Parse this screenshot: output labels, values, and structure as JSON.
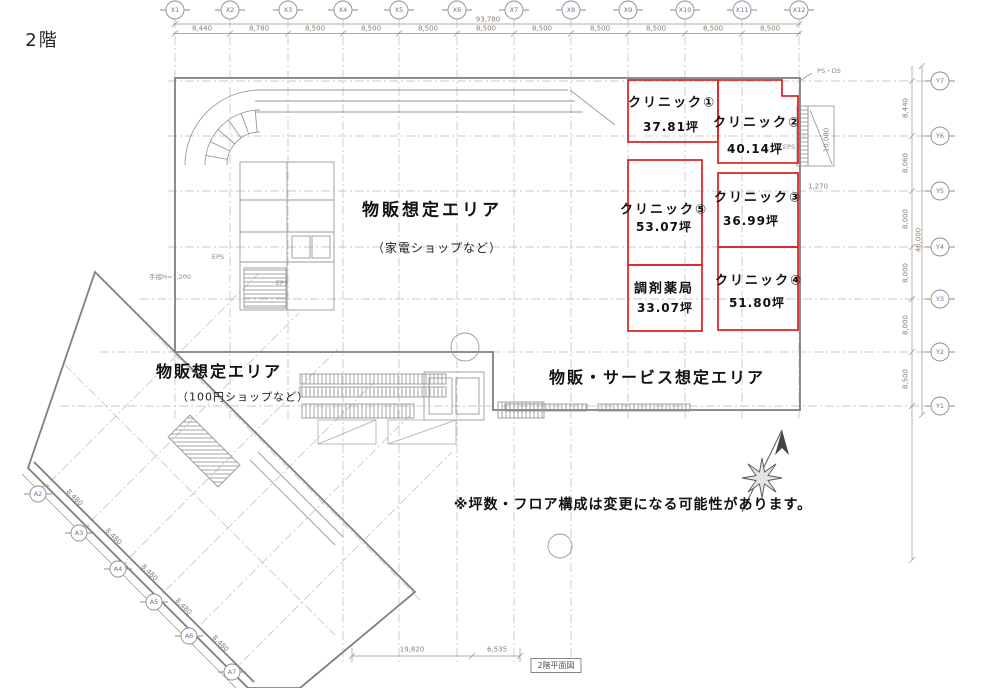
{
  "title": "2階",
  "plan_caption": "2階平面図",
  "note": "※坪数・フロア構成は変更になる可能性があります。",
  "areas": {
    "main": {
      "label": "物販想定エリア",
      "sub": "（家電ショップなど）"
    },
    "wing": {
      "label": "物販想定エリア",
      "sub": "（100円ショップなど）"
    },
    "service": {
      "label": "物販・サービス想定エリア"
    }
  },
  "units": [
    {
      "name": "クリニック①",
      "size": "37.81坪"
    },
    {
      "name": "クリニック②",
      "size": "40.14坪"
    },
    {
      "name": "クリニック③",
      "size": "36.99坪"
    },
    {
      "name": "クリニック④",
      "size": "51.80坪"
    },
    {
      "name": "クリニック⑤",
      "size": "53.07坪"
    },
    {
      "name": "調剤薬局",
      "size": "33.07坪"
    }
  ],
  "axes": {
    "x": [
      "X1",
      "X2",
      "X3",
      "X4",
      "X5",
      "X6",
      "X7",
      "X8",
      "X9",
      "X10",
      "X11",
      "X12"
    ],
    "y": [
      "Y7",
      "Y6",
      "Y5",
      "Y4",
      "Y3",
      "Y2",
      "Y1"
    ],
    "a": [
      "A2",
      "A3",
      "A4",
      "A5",
      "A6",
      "A7"
    ]
  },
  "dims": {
    "top_total": "93,780",
    "top": [
      "8,440",
      "8,780",
      "8,500",
      "8,500",
      "8,500",
      "8,500",
      "8,500",
      "8,500",
      "8,500",
      "8,500",
      "8,500"
    ],
    "right": [
      "8,440",
      "8,060",
      "8,000",
      "8,000",
      "8,000",
      "8,500"
    ],
    "right_total": "46,000",
    "diag": [
      "8,480",
      "8,480",
      "8,480",
      "8,480",
      "8,480"
    ],
    "bottom": [
      "19,820",
      "6,535"
    ],
    "stair_width": "10,080",
    "offset": "1,270"
  },
  "small_labels": {
    "ps_ds": "PS・DS",
    "eps_a": "EPS",
    "eps_b": "EPS",
    "eps_c": "EPS",
    "handrail": "手摺H=1,200"
  },
  "colors": {
    "unit_outline": "#d92b2b",
    "wall": "#7f7f7f",
    "grid": "#b9b9b9",
    "dim_text": "#8b7f70",
    "axis_text": "#64779e",
    "text": "#111111"
  }
}
